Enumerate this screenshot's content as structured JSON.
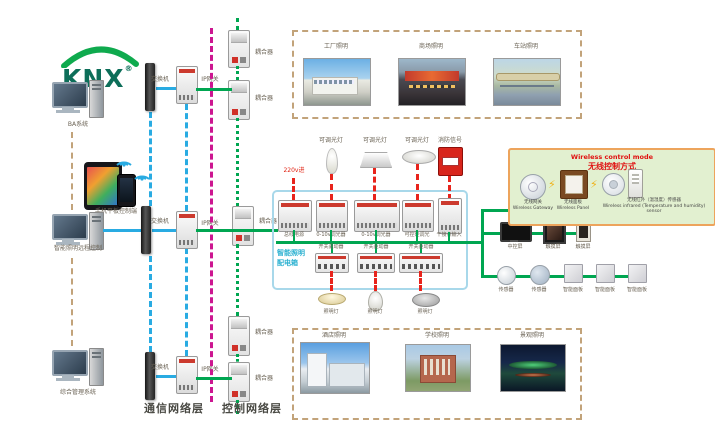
{
  "logo": {
    "text": "KNX",
    "reg": "®"
  },
  "layers": {
    "communication": "通信网络层",
    "control": "控制网络层"
  },
  "terminals": {
    "ba_system": "BA系统",
    "mobile_tablet": "手机平板控制端",
    "lighting_remote": "智能照明远程控制",
    "integrated_mgmt": "综合管理系统"
  },
  "network": {
    "switch": "交换机",
    "ip_gateway": "IP网关",
    "coupler": "耦合器"
  },
  "scenes_top": {
    "factory": "工厂照明",
    "mall": "商场照明",
    "station": "车站照明"
  },
  "scenes_bottom": {
    "hotel": "酒店照明",
    "school": "学校照明",
    "landscape": "景观照明"
  },
  "panel": {
    "name_line1": "智能照明",
    "name_line2": "配电箱",
    "power_in": "220v进",
    "bus_power": "总线电源",
    "dimmer_0_10v": "0-10v调光器",
    "scr_dimmer": "可控硅调光",
    "dry_contact": "干接点输入",
    "switch_driver": "开关驱动器",
    "dimmable_lamp": "可调光灯",
    "fire_signal": "消防信号",
    "lamp": "照明灯"
  },
  "wireless": {
    "title_en": "Wireless control mode",
    "title_zh": "无线控制方式",
    "gateway_zh": "无线网关",
    "gateway_en": "Wireless Gateway",
    "panel_zh": "无线面板",
    "panel_en": "Wireless Panel",
    "sensor_zh": "无线红外（温湿度）传感器",
    "sensor_en": "Wireless infrared (Temperature and humidity) sensor"
  },
  "right_devices": {
    "central_screen": "中控屏",
    "touch_screen": "触摸屏",
    "sensor": "传感器",
    "smart_panel": "智能面板"
  },
  "colors": {
    "green_bus": "#00a651",
    "cyan_line": "#29abe2",
    "magenta_line": "#cc1690",
    "tan_line": "#c2a37a",
    "red_line": "#e8241c",
    "panel_box_border": "#a8d8ea",
    "panel_name_text": "#2ab0d0",
    "wireless_bg": "#e2f0d0",
    "wireless_border": "#eda45c",
    "wireless_title": "#e01010"
  }
}
